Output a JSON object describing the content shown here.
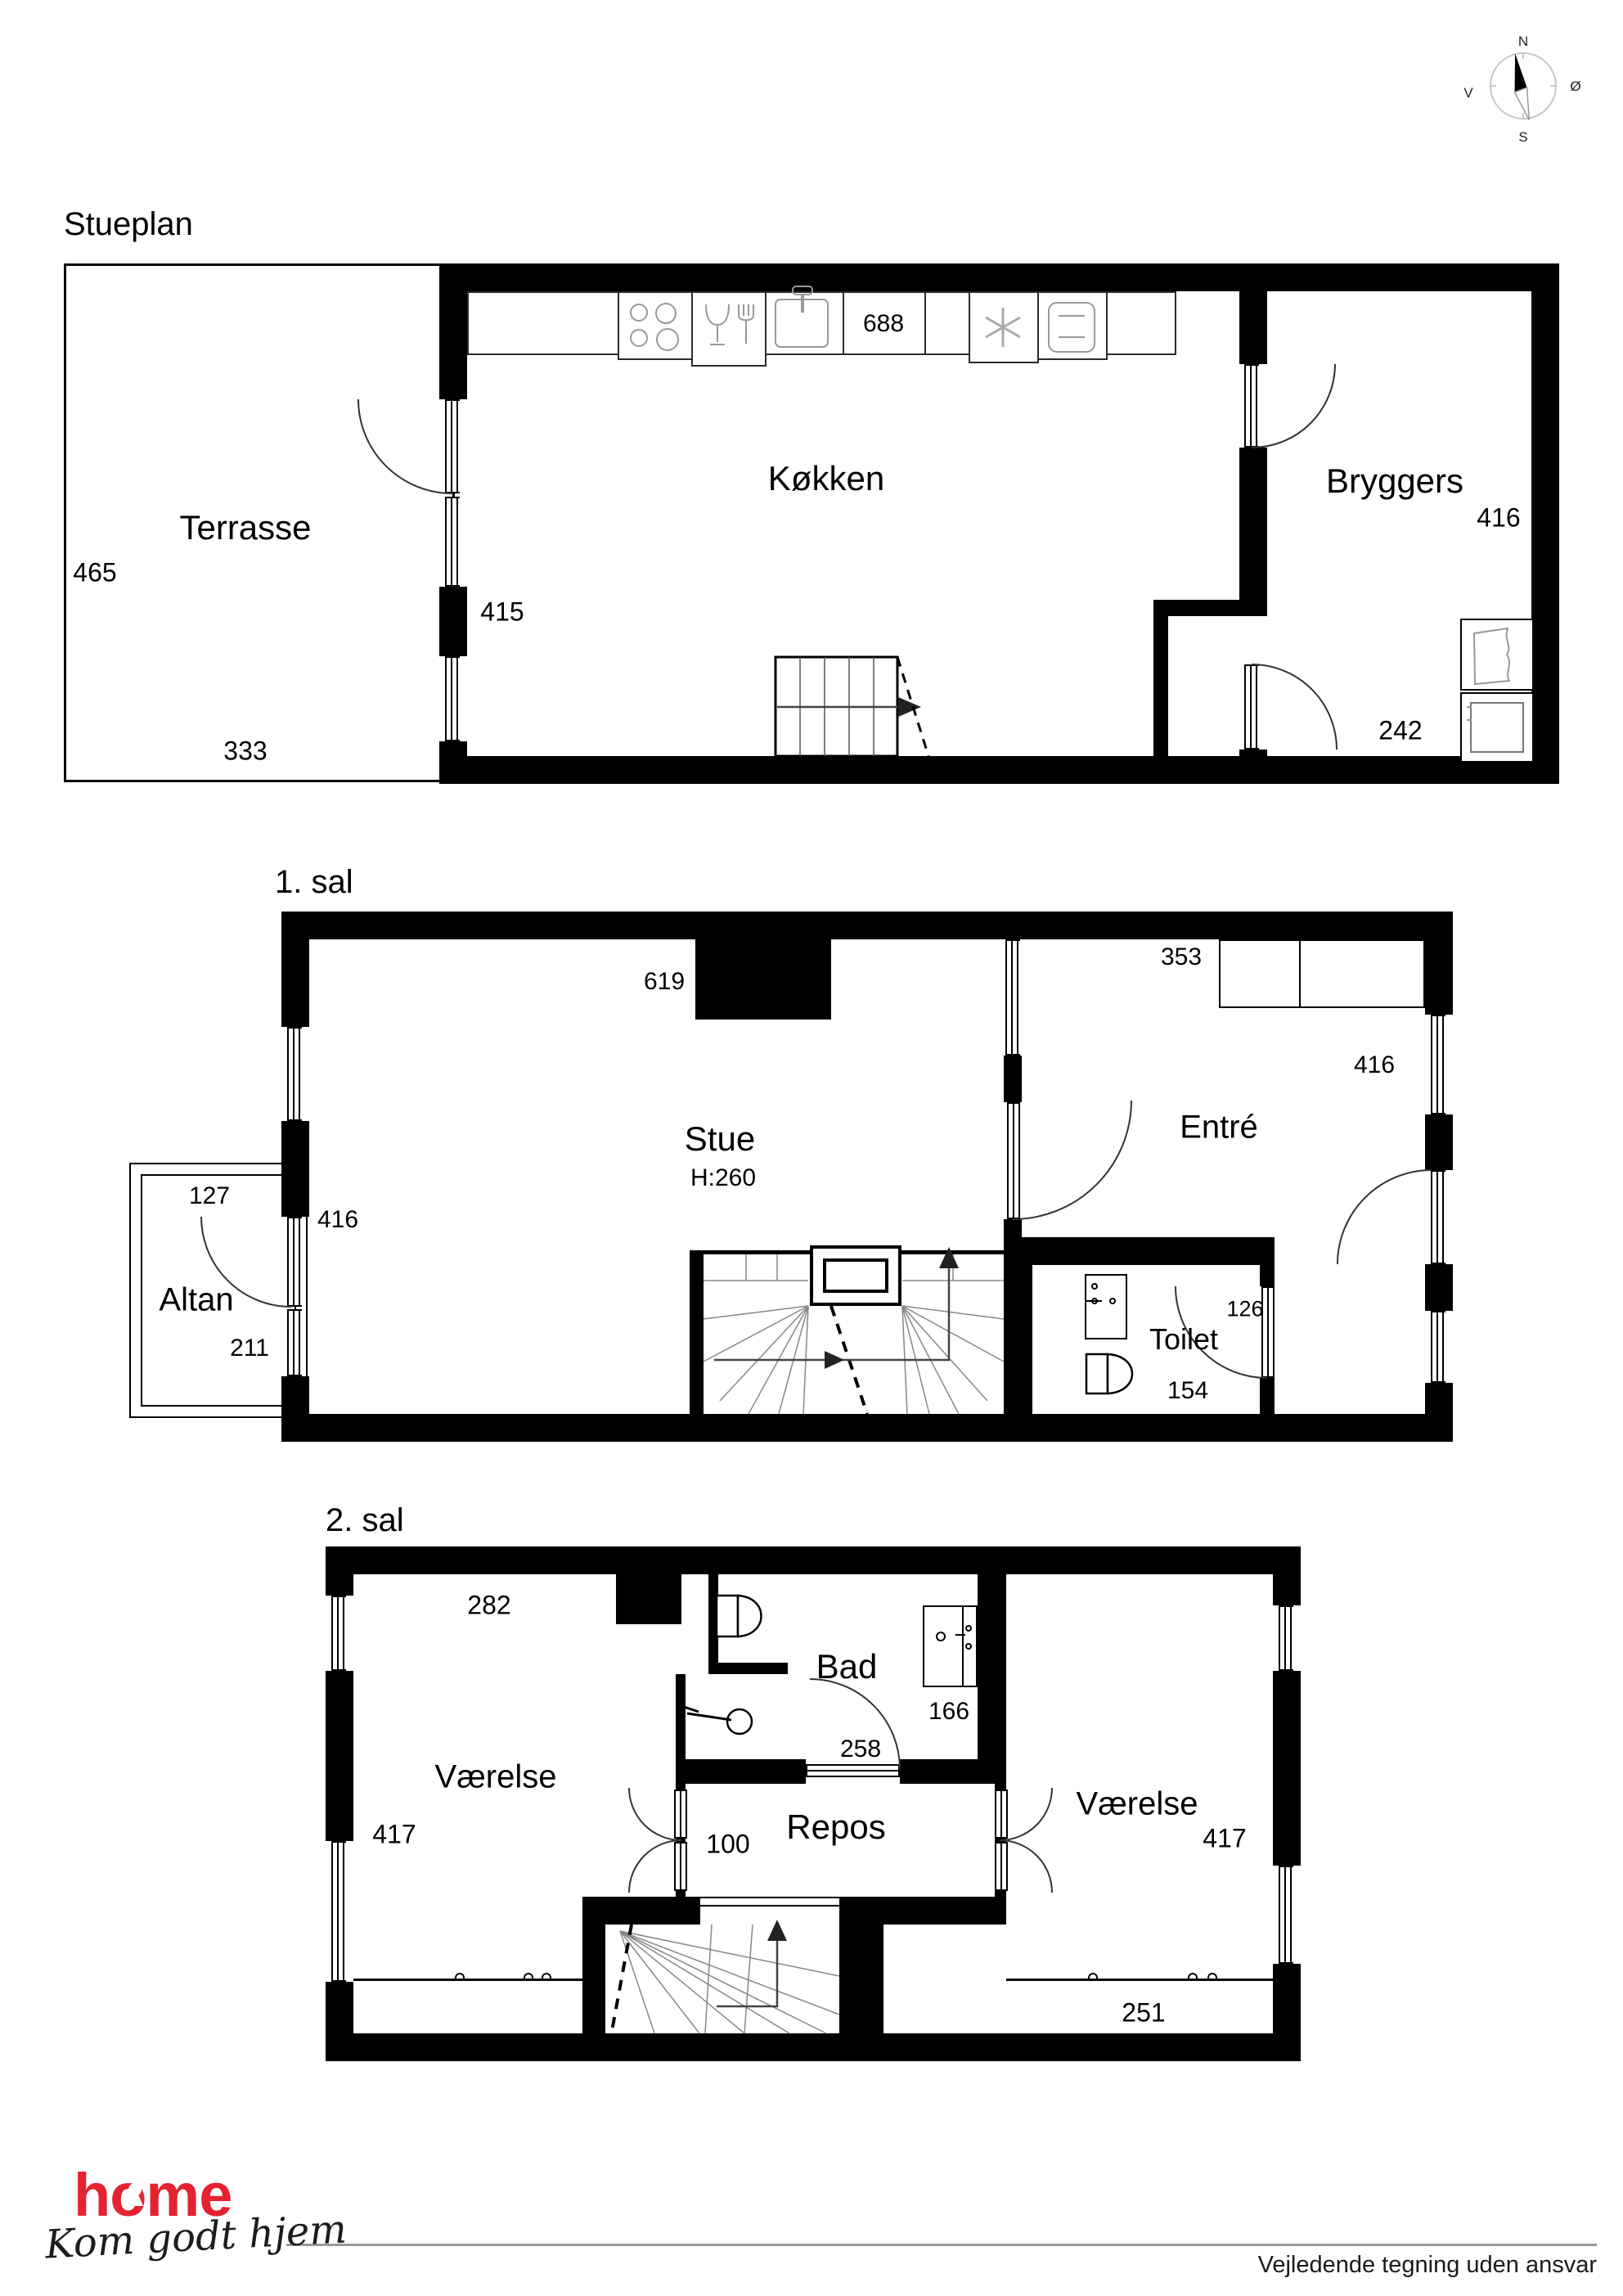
{
  "compass": {
    "north": "N",
    "east": "Ø",
    "south": "S",
    "west": "V"
  },
  "floors": [
    {
      "title": "Stueplan",
      "rooms": {
        "terrasse": "Terrasse",
        "koekken": "Køkken",
        "bryggers": "Bryggers"
      },
      "dims": {
        "d465": "465",
        "d333": "333",
        "d415": "415",
        "d688": "688",
        "d416": "416",
        "d242": "242"
      }
    },
    {
      "title": "1. sal",
      "rooms": {
        "stue": "Stue",
        "stue_h": "H:260",
        "entre": "Entré",
        "altan": "Altan",
        "toilet": "Toilet"
      },
      "dims": {
        "d619": "619",
        "d353": "353",
        "d416_stue": "416",
        "d416_entre": "416",
        "d127": "127",
        "d211": "211",
        "d126": "126",
        "d154": "154"
      }
    },
    {
      "title": "2. sal",
      "rooms": {
        "vaerelse_left": "Værelse",
        "vaerelse_right": "Værelse",
        "bad": "Bad",
        "repos": "Repos"
      },
      "dims": {
        "d282": "282",
        "d417_left": "417",
        "d417_right": "417",
        "d166": "166",
        "d258": "258",
        "d100": "100",
        "d251": "251"
      }
    }
  ],
  "footer": {
    "logo": "home",
    "tagline": "Kom godt hjem",
    "disclaimer": "Vejledende tegning uden ansvar"
  },
  "colors": {
    "wall": "#000000",
    "fixture_gray": "#999999",
    "brand_red": "#e32330"
  }
}
